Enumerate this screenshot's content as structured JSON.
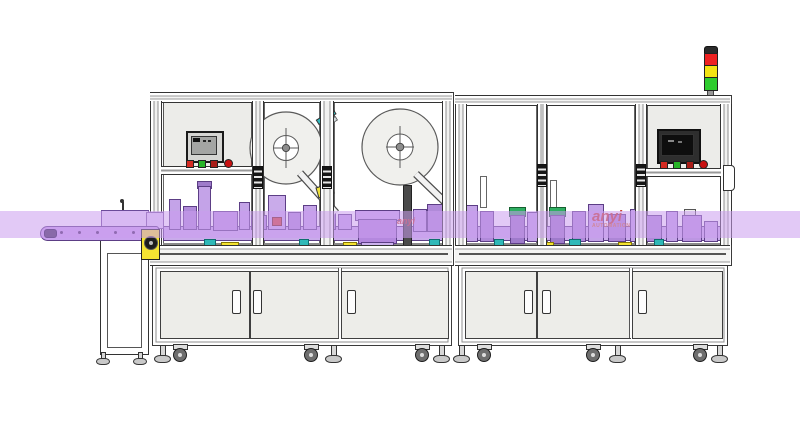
{
  "drawing": {
    "description": "technical line drawing of an automated labeling and packaging machine line with conveyor, two label reels, HMI panels, enclosure cabinets and signal tower",
    "watermark": {
      "brand": "anyi",
      "caption": "AUTOMATION"
    },
    "stack_light_order_top_to_bottom": [
      "red",
      "yellow",
      "green"
    ],
    "hmi_left_buttons": [
      "red",
      "green",
      "red",
      "red"
    ],
    "hmi_right_buttons": [
      "red",
      "green",
      "red",
      "red"
    ]
  },
  "colors": {
    "outline": "#3b3b3b",
    "panel": "#ECECE9",
    "door": "#EDEDE9",
    "band": "rgba(202,157,239,0.55)",
    "m1": "#C4A3E8",
    "m2": "#B08AD9",
    "m3": "#BC96E2",
    "m4": "#9F7BCB",
    "m5": "#B488DE",
    "mflange": "#C9A6EA",
    "mrail": "#C9ABEA",
    "mdark": "#5C3E85",
    "conveyor": "#C9A2EE",
    "teal": "#2FB8B8",
    "yellow": "#F5E432",
    "redacc": "#D24234",
    "green": "#2FAE62",
    "stack_red": "#EE2222",
    "stack_yellow": "#F2E313",
    "stack_green": "#2ECC2E",
    "btn_red": "#D42A22",
    "btn_green": "#27B427",
    "wm_red": "#C93A28",
    "wm_orange": "#DA6A2B"
  }
}
